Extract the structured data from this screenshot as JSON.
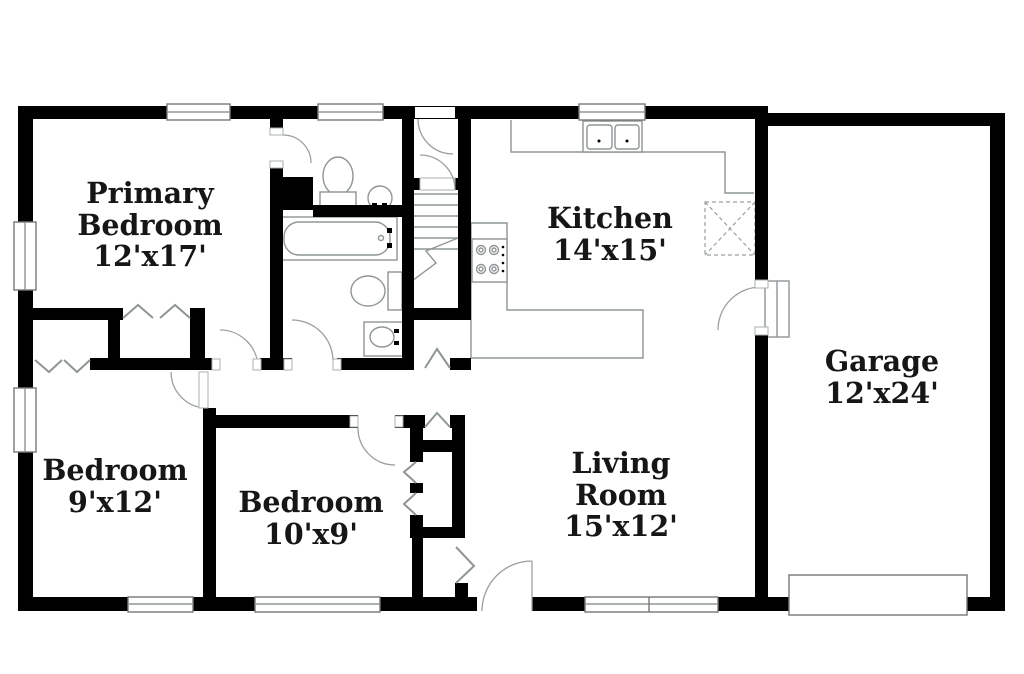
{
  "rooms": {
    "primary_bedroom": {
      "line1": "Primary",
      "line2": "Bedroom",
      "dims": "12'x17'"
    },
    "kitchen": {
      "line1": "Kitchen",
      "dims": "14'x15'"
    },
    "garage": {
      "line1": "Garage",
      "dims": "12'x24'"
    },
    "bedroom_9x12": {
      "line1": "Bedroom",
      "dims": "9'x12'"
    },
    "bedroom_10x9": {
      "line1": "Bedroom",
      "dims": "10'x9'"
    },
    "living_room": {
      "line1": "Living",
      "line2": "Room",
      "dims": "15'x12'"
    }
  },
  "fixtures": [
    "bathtub",
    "toilet",
    "round-sink",
    "pedestal-sink",
    "double-kitchen-sink",
    "range-stove",
    "refrigerator-nook",
    "basement-stairs",
    "utility-pad-x",
    "garage-entry-steps",
    "garage-door",
    "front-door",
    "window",
    "bifold-closet-door"
  ],
  "colors": {
    "wall": "#000000",
    "fixture_line": "#8f9596",
    "text": "#161616",
    "background": "#ffffff"
  }
}
